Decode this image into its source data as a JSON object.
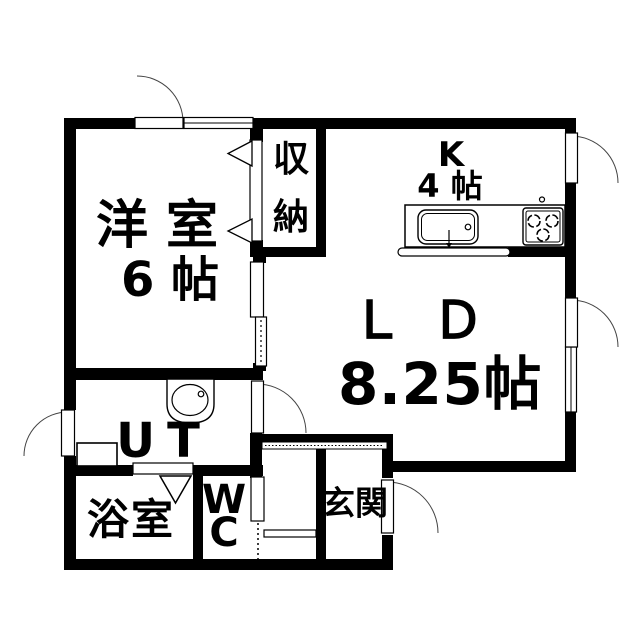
{
  "diagram_type": "apartment-floor-plan",
  "colors": {
    "wall": "#000000",
    "background": "#ffffff",
    "line": "#000000"
  },
  "rooms": {
    "western_room": {
      "name": "洋 室",
      "size": "6 帖"
    },
    "closet": {
      "char_top": "収",
      "char_bottom": "納"
    },
    "kitchen": {
      "name": "K",
      "size": "4 帖"
    },
    "living_dining": {
      "name": "ＬＤ",
      "size": "8.25帖"
    },
    "utility": {
      "name": "UT"
    },
    "bathroom": {
      "name": "浴室"
    },
    "toilet": {
      "char_top": "W",
      "char_bottom": "C"
    },
    "entrance": {
      "name": "玄関"
    }
  },
  "fixtures": [
    "kitchen-counter",
    "kitchen-sink",
    "faucet",
    "gas-stove-3-burner",
    "open-counter",
    "washbasin",
    "washing-machine-pan",
    "entrance-step"
  ],
  "door_symbols": [
    "balcony-swing-door",
    "kitchen-back-swing-door",
    "ld-side-swing-door",
    "utility-back-swing-door",
    "utility-ld-swing-door",
    "front-swing-door",
    "wc-door",
    "bathroom-folding-door",
    "closet-bifold-door",
    "sliding-door"
  ],
  "window_symbols": [
    "top-wall-window",
    "right-wall-window"
  ]
}
